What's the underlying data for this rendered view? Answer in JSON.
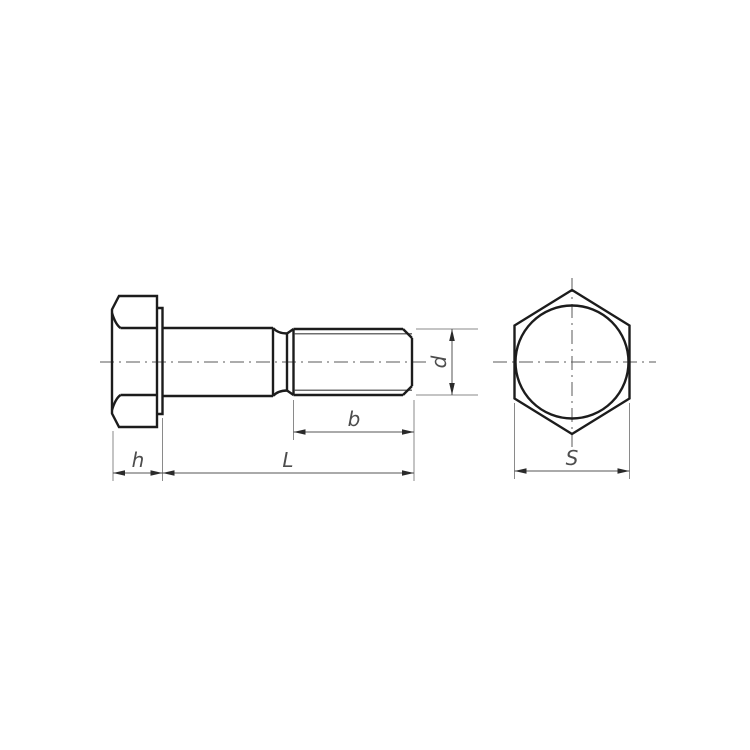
{
  "colors": {
    "background": "#ffffff",
    "outline": "#1c1c1c",
    "thin_line": "#3f3f3f",
    "centerline": "#5a5a5a",
    "dimension": "#555555",
    "extension": "#8a8a8a",
    "arrow": "#2a2a2a",
    "label": "#4d4d4d"
  },
  "dimensions": {
    "head_height_label": "h",
    "total_length_label": "L",
    "thread_length_label": "b",
    "diameter_label": "d",
    "across_flats_label": "S"
  }
}
